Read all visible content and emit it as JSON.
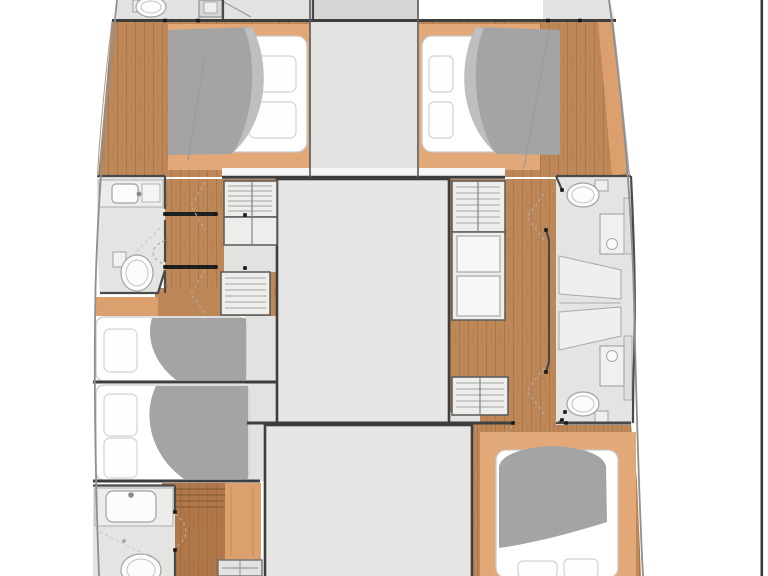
{
  "figure": {
    "kind": "catamaran-yacht-floorplan",
    "view": "top-down deck plan, bow at top, cropped at top and bottom edges",
    "hulls": 2,
    "berth_count": 5,
    "bathroom_count": 5,
    "wardrobe_cabinet_count": 6
  },
  "rooms": [
    {
      "id": "bow-head-port",
      "type": "bathroom",
      "features": [
        "toilet",
        "washbasin"
      ]
    },
    {
      "id": "forward-cabin-port",
      "type": "double-berth",
      "features": [
        "mattress",
        "2 pillows",
        "grey duvet",
        "timber platform"
      ]
    },
    {
      "id": "forward-cabin-starboard",
      "type": "double-berth",
      "features": [
        "mattress",
        "2 pillows",
        "grey duvet",
        "timber platform"
      ]
    },
    {
      "id": "head-port-mid",
      "type": "bathroom",
      "features": [
        "washbasin",
        "toilet"
      ]
    },
    {
      "id": "head-port-aft",
      "type": "bathroom",
      "features": [
        "washbasin",
        "toilet",
        "shower"
      ]
    },
    {
      "id": "head-starboard-forward",
      "type": "bathroom",
      "features": [
        "toilet",
        "washbasin"
      ]
    },
    {
      "id": "shower-starboard",
      "type": "shower-compartment"
    },
    {
      "id": "head-starboard-aft",
      "type": "bathroom",
      "features": [
        "washbasin",
        "toilet"
      ]
    },
    {
      "id": "aft-cabin-port-upper",
      "type": "single-berth"
    },
    {
      "id": "aft-cabin-port-lower",
      "type": "double-berth"
    },
    {
      "id": "aft-cabin-starboard",
      "type": "double-berth"
    },
    {
      "id": "saloon-forward-passage",
      "type": "deckhouse-passage"
    },
    {
      "id": "saloon-main-block",
      "type": "deckhouse"
    },
    {
      "id": "saloon-aft-block",
      "type": "deckhouse"
    },
    {
      "id": "corridor-port",
      "type": "timber-companionway"
    },
    {
      "id": "corridor-starboard",
      "type": "timber-companionway"
    }
  ],
  "palette": {
    "bg": "#ffffff",
    "wood": "#BE8757",
    "woodDark": "#B0784A",
    "tan": "#E3A877",
    "tanSoft": "#DCA06E",
    "floor": "#E2E2E0",
    "topGray": "#D6D6D4",
    "block": "#E6E6E4",
    "bath": "#E4E4E2",
    "sill": "#F6F6F5",
    "cabinet": "#EDEDEB",
    "duvet": "#A4A4A4",
    "duvetFold": "#BFBFBF",
    "mattress": "#FFFFFF",
    "mattressEdge": "#C9C9C9",
    "wall": "#3E3E3E",
    "fixture": "#9FA3A3",
    "hull": "#8F8F8F",
    "dot": "#161616",
    "border": "#3A3A3A"
  }
}
